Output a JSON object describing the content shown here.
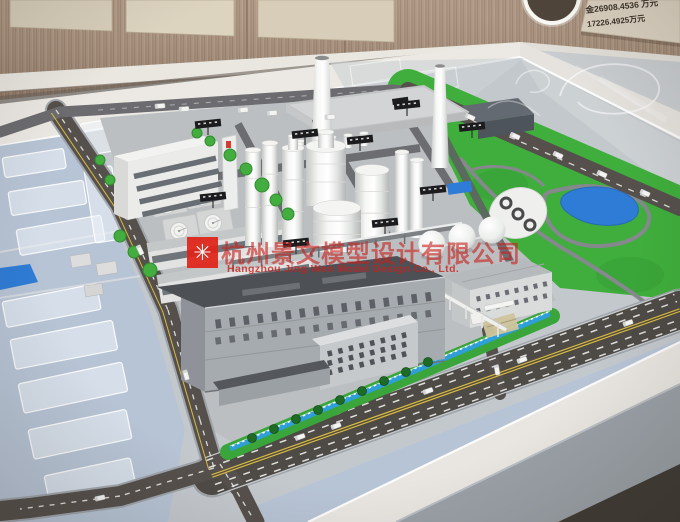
{
  "watermark": {
    "logo_icon": "asterisk-flower-icon",
    "logo_glyph": "✳",
    "company_cn": "杭州景文模型设计有限公司",
    "company_en": "Hangzhou Jing Wen Model Design Co., Ltd."
  },
  "wall_sign": {
    "line1": "金26908.4536 万元",
    "line2": "17226.4925万元"
  },
  "colors": {
    "watermark_red": "#c8201c",
    "logo_red": "#e02318",
    "wood_wall": "#a68f7c",
    "wall_panel": "#d9d0bc",
    "sign_board": "#ddd3c3",
    "sign_text": "#3d342a",
    "table_rim": "#eae7e1",
    "base_gray": "#c3c8cd",
    "plot_blue": "#b7c4d5",
    "grass_green": "#3fae3c",
    "pond_blue": "#2e7cd6",
    "asphalt": "#4e4a46"
  }
}
